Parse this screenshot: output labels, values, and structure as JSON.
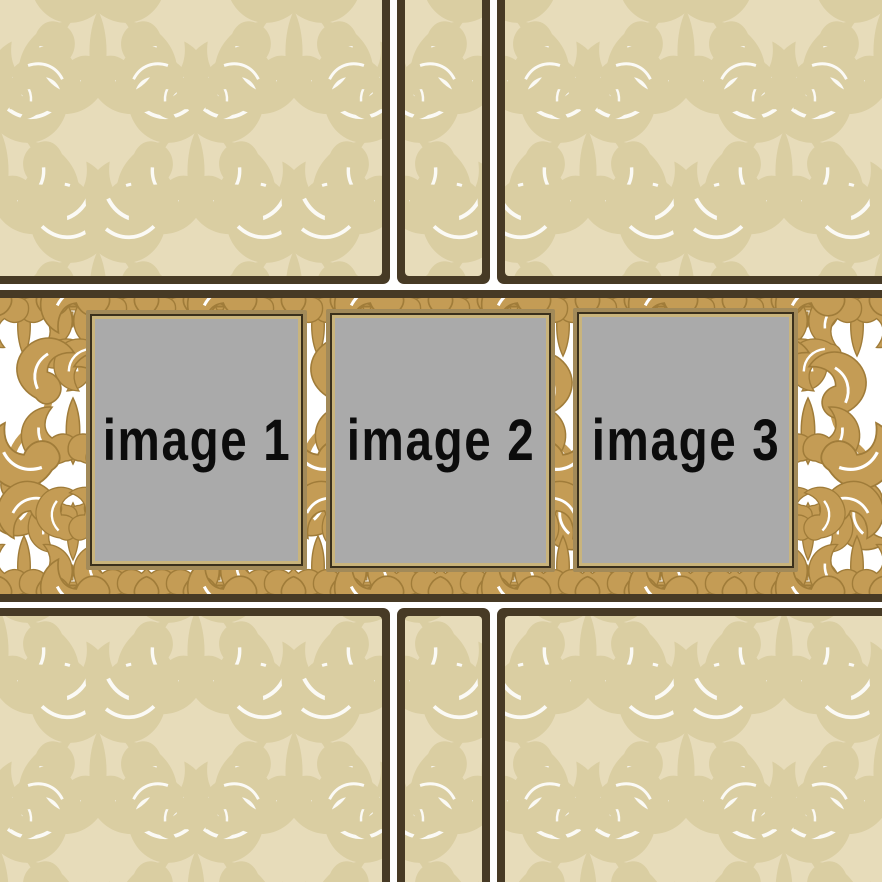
{
  "placeholders": [
    {
      "label": "image 1"
    },
    {
      "label": "image 2"
    },
    {
      "label": "image 3"
    }
  ],
  "colors": {
    "background_beige": "#e7dcba",
    "beige_damask_motif": "#d8cb9e",
    "divider_brown": "#473a25",
    "band_white": "#ffffff",
    "damask_gold": "#c49c55",
    "damask_gold_outline": "#a07c39",
    "placeholder_gray": "#aaaaaa",
    "frame_tan_outer": "#a28a59",
    "frame_brown_line": "#3a301c",
    "frame_tan_inner": "#c9b47c",
    "label_color": "#0c0c0c"
  }
}
